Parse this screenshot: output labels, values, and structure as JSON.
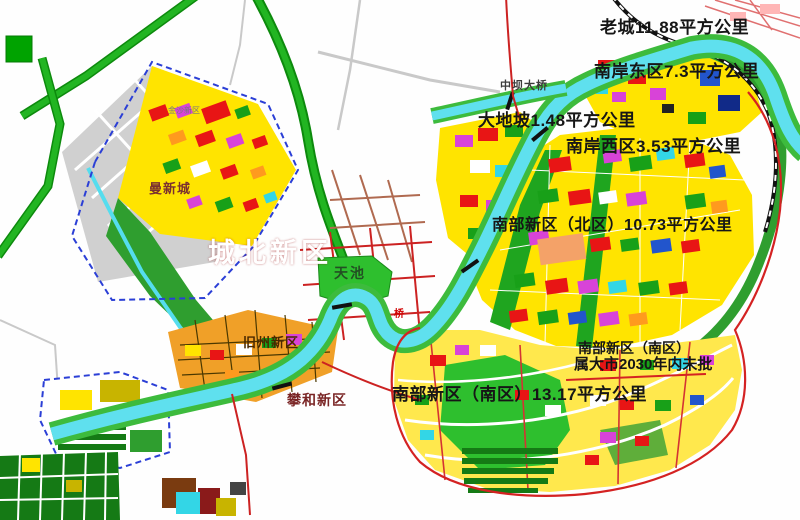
{
  "map": {
    "kind": "urban-master-plan-map",
    "labels": {
      "old_city": "老城11.88平方公里",
      "nanan_east": "南岸东区7.3平方公里",
      "zhongba_bridge": "中坝大桥",
      "dadipo": "大地坡1.48平方公里",
      "nanan_west": "南岸西区3.53平方公里",
      "nanbu_north": "南部新区（北区）10.73平方公里",
      "nanbu_south_name": "南部新区（南区）",
      "nanbu_south_note": "属大市2030年内未批",
      "nanbu_south_area": "南部新区（南区）13.17平方公里",
      "chengbei": "城北新区",
      "tianchi": "天池",
      "man_xin_cheng": "曼新城",
      "jiuzhou": "旧州新区",
      "pan_he": "攀和新区",
      "qiao": "桥",
      "nw_tiny": "金沙新区"
    },
    "districts": [
      {
        "name": "老城",
        "area": "11.88平方公里"
      },
      {
        "name": "南岸东区",
        "area": "7.3平方公里"
      },
      {
        "name": "大地坡",
        "area": "1.48平方公里"
      },
      {
        "name": "南岸西区",
        "area": "3.53平方公里"
      },
      {
        "name": "南部新区（北区）",
        "area": "10.73平方公里"
      },
      {
        "name": "南部新区（南区）",
        "area": "13.17平方公里",
        "note": "属大市2030年内未批"
      },
      {
        "name": "城北新区"
      },
      {
        "name": "曼新城"
      },
      {
        "name": "旧州新区"
      },
      {
        "name": "攀和新区"
      }
    ],
    "palette": {
      "red_zone": "#ec1c1c",
      "water_cyan": "#5fe0ee",
      "river_bank_green": "#3dbb3d",
      "park_green": "#2ebf2e",
      "block_yellow": "#ffe400",
      "orange_district": "#f0a028",
      "boundary_red": "#d42222",
      "planning_dash_blue": "#2b3fd6",
      "urban_gray": "#d0d0d0"
    }
  }
}
